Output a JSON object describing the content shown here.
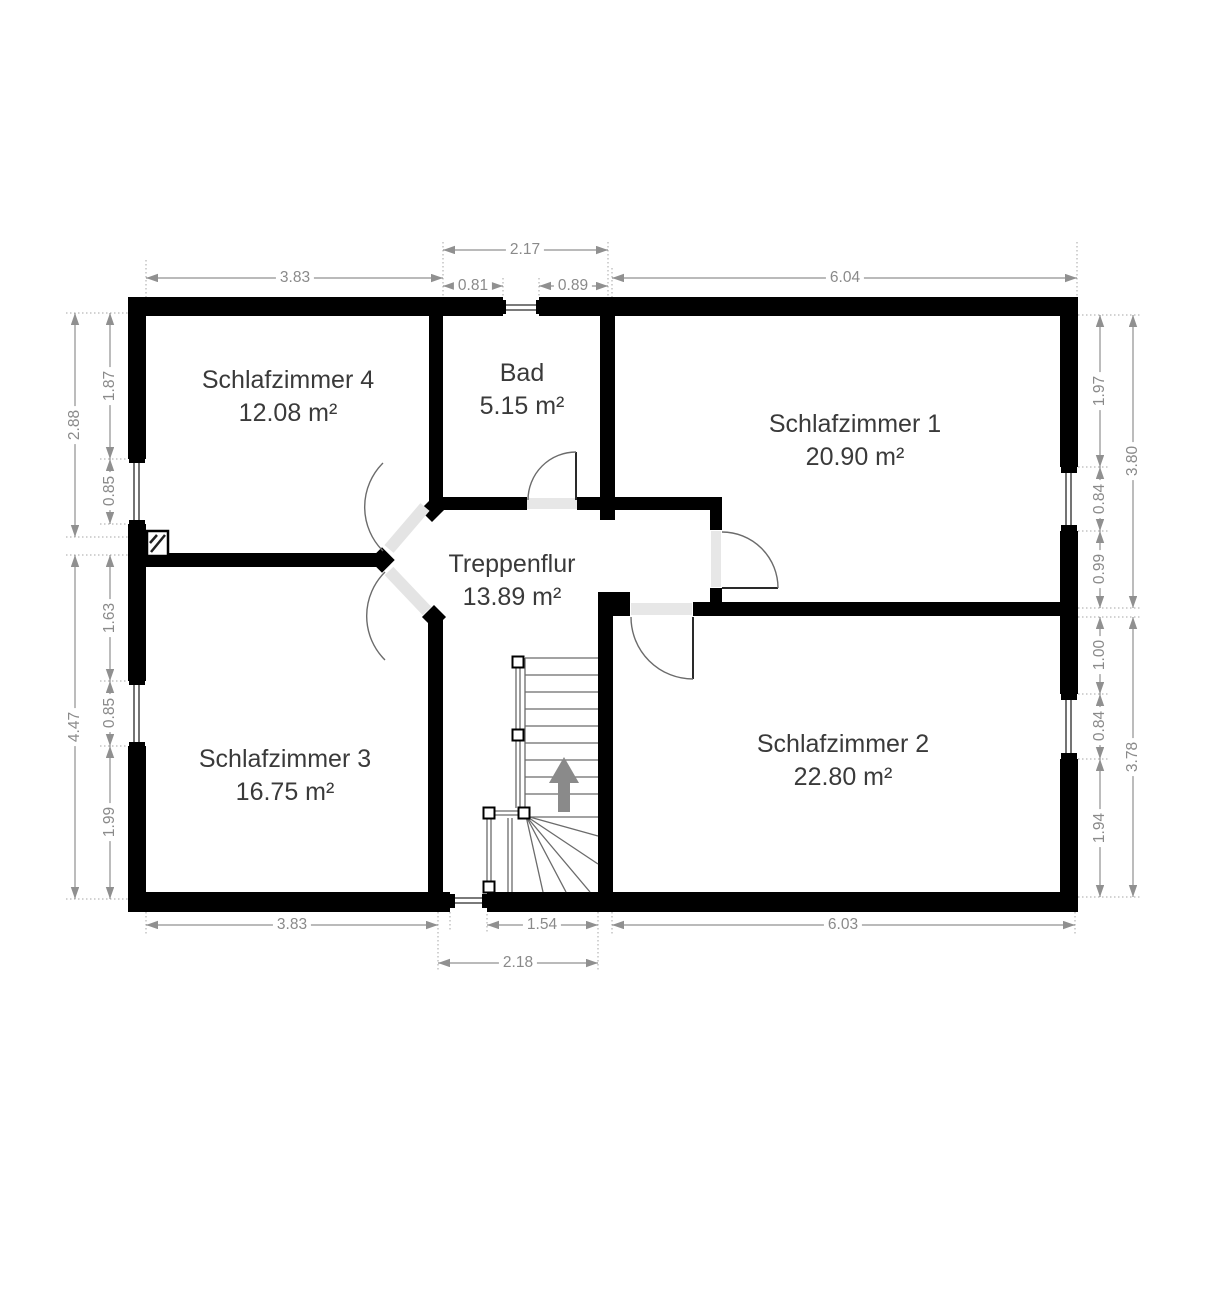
{
  "plan": {
    "floor_name": "Obergeschoss floor plan",
    "rooms": {
      "sz4": {
        "name": "Schlafzimmer 4",
        "area": "12.08 m²"
      },
      "bad": {
        "name": "Bad",
        "area": "5.15 m²"
      },
      "sz1": {
        "name": "Schlafzimmer 1",
        "area": "20.90 m²"
      },
      "flur": {
        "name": "Treppenflur",
        "area": "13.89 m²"
      },
      "sz3": {
        "name": "Schlafzimmer 3",
        "area": "16.75 m²"
      },
      "sz2": {
        "name": "Schlafzimmer 2",
        "area": "22.80 m²"
      }
    },
    "dims": {
      "t217": "2.17",
      "t383": "3.83",
      "t081": "0.81",
      "t089": "0.89",
      "t604": "6.04",
      "l288": "2.88",
      "l187": "1.87",
      "l085a": "0.85",
      "l447": "4.47",
      "l163": "1.63",
      "l085b": "0.85",
      "l199": "1.99",
      "r197": "1.97",
      "r084a": "0.84",
      "r099": "0.99",
      "r380": "3.80",
      "r100": "1.00",
      "r084b": "0.84",
      "r194": "1.94",
      "r378": "3.78",
      "b383": "3.83",
      "b154": "1.54",
      "b603": "6.03",
      "b218": "2.18"
    },
    "colors": {
      "wall": "#000000",
      "threshold": "#e7e7e7",
      "dim_line": "#909090",
      "dim_text": "#8a8a8a",
      "room_text": "#3a3a3a",
      "stair_line": "#6b6b6b",
      "arrow": "#8a8a8a"
    }
  }
}
